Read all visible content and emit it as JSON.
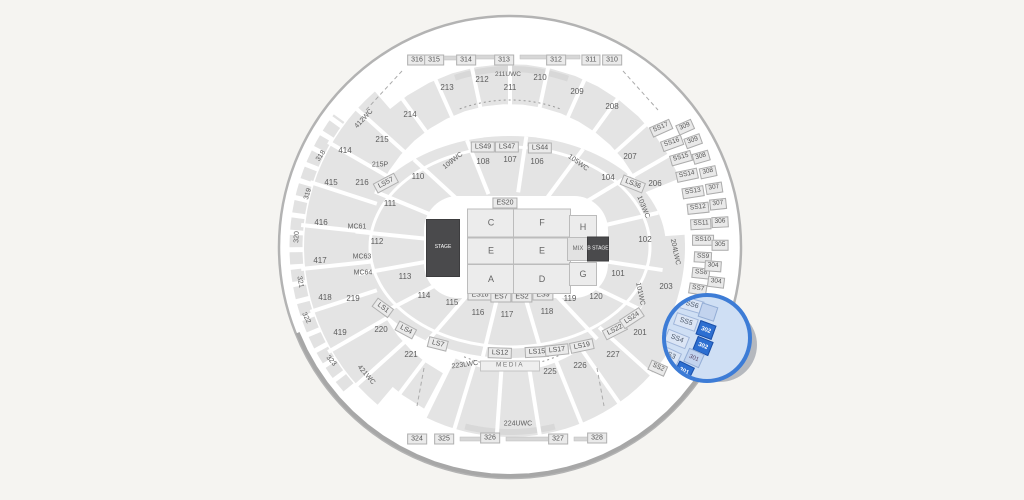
{
  "colors": {
    "background": "#f5f4f1",
    "arena_fill": "#ffffff",
    "rim": "#b3b3b3",
    "section_gray": "#e4e4e4",
    "label_text": "#5d5d5d",
    "stage_dark": "#4a4a4c",
    "magnifier_ring": "#3d7cd6",
    "magnifier_fill": "#cfdff4",
    "selected_section": "#2d6fd1"
  },
  "labels": [
    {
      "t": "316",
      "x": 417,
      "y": 60,
      "k": "tb"
    },
    {
      "t": "315",
      "x": 434,
      "y": 60,
      "k": "tb"
    },
    {
      "t": "314",
      "x": 466,
      "y": 60,
      "k": "tb"
    },
    {
      "t": "313",
      "x": 504,
      "y": 60,
      "k": "tb"
    },
    {
      "t": "312",
      "x": 556,
      "y": 60,
      "k": "tb"
    },
    {
      "t": "311",
      "x": 591,
      "y": 60,
      "k": "tb"
    },
    {
      "t": "310",
      "x": 612,
      "y": 60,
      "k": "tb"
    },
    {
      "t": "324",
      "x": 417,
      "y": 439,
      "k": "tb"
    },
    {
      "t": "325",
      "x": 444,
      "y": 439,
      "k": "tb"
    },
    {
      "t": "326",
      "x": 490,
      "y": 438,
      "k": "tb"
    },
    {
      "t": "327",
      "x": 558,
      "y": 439,
      "k": "tb"
    },
    {
      "t": "328",
      "x": 597,
      "y": 438,
      "k": "tb"
    },
    {
      "t": "214",
      "x": 410,
      "y": 115
    },
    {
      "t": "213",
      "x": 447,
      "y": 88
    },
    {
      "t": "212",
      "x": 482,
      "y": 80
    },
    {
      "t": "211",
      "x": 510,
      "y": 88
    },
    {
      "t": "210",
      "x": 540,
      "y": 78
    },
    {
      "t": "209",
      "x": 577,
      "y": 92
    },
    {
      "t": "208",
      "x": 612,
      "y": 107
    },
    {
      "t": "215",
      "x": 382,
      "y": 140
    },
    {
      "t": "216",
      "x": 362,
      "y": 183
    },
    {
      "t": "219",
      "x": 353,
      "y": 299
    },
    {
      "t": "220",
      "x": 381,
      "y": 330
    },
    {
      "t": "221",
      "x": 411,
      "y": 355
    },
    {
      "t": "225",
      "x": 550,
      "y": 372
    },
    {
      "t": "226",
      "x": 580,
      "y": 366
    },
    {
      "t": "227",
      "x": 613,
      "y": 355
    },
    {
      "t": "201",
      "x": 640,
      "y": 333
    },
    {
      "t": "203",
      "x": 666,
      "y": 287
    },
    {
      "t": "206",
      "x": 655,
      "y": 184
    },
    {
      "t": "207",
      "x": 630,
      "y": 157
    },
    {
      "t": "215P",
      "x": 380,
      "y": 165,
      "s": 7
    },
    {
      "t": "211UWC",
      "x": 508,
      "y": 75,
      "s": 6.5
    },
    {
      "t": "224UWC",
      "x": 518,
      "y": 424,
      "s": 7
    },
    {
      "t": "223LWC",
      "x": 465,
      "y": 365,
      "s": 7,
      "r": -8
    },
    {
      "t": "204LWC",
      "x": 675,
      "y": 252,
      "s": 7,
      "r": 78
    },
    {
      "t": "414",
      "x": 345,
      "y": 151
    },
    {
      "t": "415",
      "x": 331,
      "y": 183
    },
    {
      "t": "416",
      "x": 321,
      "y": 223
    },
    {
      "t": "417",
      "x": 320,
      "y": 261
    },
    {
      "t": "418",
      "x": 325,
      "y": 298
    },
    {
      "t": "419",
      "x": 340,
      "y": 333
    },
    {
      "t": "412WC",
      "x": 364,
      "y": 119,
      "s": 7,
      "r": -47
    },
    {
      "t": "421WC",
      "x": 366,
      "y": 375,
      "s": 7,
      "r": 49
    },
    {
      "t": "318",
      "x": 321,
      "y": 156,
      "s": 7,
      "r": -56
    },
    {
      "t": "319",
      "x": 308,
      "y": 194,
      "s": 7,
      "r": -73
    },
    {
      "t": "320",
      "x": 297,
      "y": 237,
      "s": 7,
      "r": -88
    },
    {
      "t": "321",
      "x": 300,
      "y": 282,
      "s": 7,
      "r": 79
    },
    {
      "t": "322",
      "x": 306,
      "y": 318,
      "s": 7,
      "r": 63
    },
    {
      "t": "323",
      "x": 331,
      "y": 361,
      "s": 7,
      "r": 48
    },
    {
      "t": "101",
      "x": 618,
      "y": 274
    },
    {
      "t": "102",
      "x": 645,
      "y": 240
    },
    {
      "t": "104",
      "x": 608,
      "y": 178
    },
    {
      "t": "106",
      "x": 537,
      "y": 162
    },
    {
      "t": "107",
      "x": 510,
      "y": 160
    },
    {
      "t": "108",
      "x": 483,
      "y": 162
    },
    {
      "t": "110",
      "x": 418,
      "y": 177
    },
    {
      "t": "111",
      "x": 390,
      "y": 204
    },
    {
      "t": "112",
      "x": 377,
      "y": 242
    },
    {
      "t": "113",
      "x": 405,
      "y": 277
    },
    {
      "t": "114",
      "x": 424,
      "y": 296
    },
    {
      "t": "115",
      "x": 452,
      "y": 303
    },
    {
      "t": "116",
      "x": 478,
      "y": 313
    },
    {
      "t": "117",
      "x": 507,
      "y": 315
    },
    {
      "t": "118",
      "x": 547,
      "y": 312
    },
    {
      "t": "119",
      "x": 570,
      "y": 299
    },
    {
      "t": "120",
      "x": 596,
      "y": 297
    },
    {
      "t": "109WC",
      "x": 453,
      "y": 161,
      "s": 7,
      "r": -38
    },
    {
      "t": "105WC",
      "x": 578,
      "y": 163,
      "s": 7,
      "r": 36
    },
    {
      "t": "103WC",
      "x": 643,
      "y": 207,
      "s": 7,
      "r": 68
    },
    {
      "t": "101WC",
      "x": 640,
      "y": 294,
      "s": 7,
      "r": 78
    },
    {
      "t": "MC61",
      "x": 357,
      "y": 227,
      "s": 7
    },
    {
      "t": "MC63",
      "x": 362,
      "y": 257,
      "s": 7
    },
    {
      "t": "MC64",
      "x": 363,
      "y": 273,
      "s": 7
    },
    {
      "t": "LS49",
      "x": 483,
      "y": 147,
      "k": "tb"
    },
    {
      "t": "LS47",
      "x": 507,
      "y": 147,
      "k": "tb"
    },
    {
      "t": "LS44",
      "x": 540,
      "y": 148,
      "k": "tb"
    },
    {
      "t": "LS36",
      "x": 633,
      "y": 184,
      "k": "tb",
      "r": 22
    },
    {
      "t": "LS57",
      "x": 386,
      "y": 183,
      "k": "tb",
      "r": -28
    },
    {
      "t": "LS1",
      "x": 383,
      "y": 308,
      "k": "tb",
      "r": 36
    },
    {
      "t": "LS4",
      "x": 406,
      "y": 330,
      "k": "tb",
      "r": 28
    },
    {
      "t": "LS7",
      "x": 438,
      "y": 344,
      "k": "tb",
      "r": 14
    },
    {
      "t": "LS12",
      "x": 500,
      "y": 353,
      "k": "tb",
      "r": 2
    },
    {
      "t": "LS15",
      "x": 537,
      "y": 352,
      "k": "tb",
      "r": -3
    },
    {
      "t": "LS17",
      "x": 557,
      "y": 350,
      "k": "tb",
      "r": -6
    },
    {
      "t": "LS19",
      "x": 582,
      "y": 346,
      "k": "tb",
      "r": -12
    },
    {
      "t": "LS22",
      "x": 615,
      "y": 330,
      "k": "tb",
      "r": -27
    },
    {
      "t": "LS24",
      "x": 632,
      "y": 318,
      "k": "tb",
      "r": -33
    },
    {
      "t": "ES20",
      "x": 505,
      "y": 203,
      "k": "tb"
    },
    {
      "t": "ES18",
      "x": 480,
      "y": 295,
      "k": "tb"
    },
    {
      "t": "ES7",
      "x": 501,
      "y": 297,
      "k": "tb"
    },
    {
      "t": "ES2",
      "x": 522,
      "y": 297,
      "k": "tb"
    },
    {
      "t": "ES9",
      "x": 543,
      "y": 295,
      "k": "tb"
    },
    {
      "t": "MEDIA",
      "x": 510,
      "y": 366,
      "k": "strip",
      "i": false
    },
    {
      "t": "SS17",
      "x": 661,
      "y": 128,
      "k": "sb",
      "r": -24
    },
    {
      "t": "SS16",
      "x": 672,
      "y": 143,
      "k": "sb",
      "r": -20
    },
    {
      "t": "SS15",
      "x": 681,
      "y": 158,
      "k": "sb",
      "r": -16
    },
    {
      "t": "SS14",
      "x": 687,
      "y": 175,
      "k": "sb",
      "r": -12
    },
    {
      "t": "SS13",
      "x": 693,
      "y": 192,
      "k": "sb",
      "r": -9
    },
    {
      "t": "SS12",
      "x": 698,
      "y": 208,
      "k": "sb",
      "r": -6
    },
    {
      "t": "SS11",
      "x": 701,
      "y": 224,
      "k": "sb",
      "r": -3
    },
    {
      "t": "SS10",
      "x": 703,
      "y": 240,
      "k": "sb",
      "r": 0
    },
    {
      "t": "SS9",
      "x": 703,
      "y": 257,
      "k": "sb",
      "r": 3
    },
    {
      "t": "SS8",
      "x": 701,
      "y": 273,
      "k": "sb",
      "r": 6
    },
    {
      "t": "SS7",
      "x": 698,
      "y": 289,
      "k": "sb",
      "r": 9
    },
    {
      "t": "SS2",
      "x": 658,
      "y": 368,
      "k": "sb",
      "r": 24
    },
    {
      "t": "309",
      "x": 685,
      "y": 127,
      "k": "sb",
      "r": -24
    },
    {
      "t": "309",
      "x": 693,
      "y": 141,
      "k": "sb",
      "r": -20
    },
    {
      "t": "308",
      "x": 701,
      "y": 157,
      "k": "sb",
      "r": -16
    },
    {
      "t": "308",
      "x": 708,
      "y": 172,
      "k": "sb",
      "r": -12
    },
    {
      "t": "307",
      "x": 714,
      "y": 188,
      "k": "sb",
      "r": -9
    },
    {
      "t": "307",
      "x": 718,
      "y": 204,
      "k": "sb",
      "r": -6
    },
    {
      "t": "306",
      "x": 720,
      "y": 222,
      "k": "sb",
      "r": -3
    },
    {
      "t": "305",
      "x": 720,
      "y": 245,
      "k": "sb",
      "r": 0
    },
    {
      "t": "304",
      "x": 713,
      "y": 266,
      "k": "sb",
      "r": 4
    },
    {
      "t": "304",
      "x": 716,
      "y": 282,
      "k": "sb",
      "r": 7
    }
  ],
  "floor": [
    {
      "t": "C",
      "x": 491,
      "y": 223,
      "w": 46,
      "h": 27,
      "k": "fb"
    },
    {
      "t": "F",
      "x": 542,
      "y": 223,
      "w": 56,
      "h": 27,
      "k": "fb"
    },
    {
      "t": "E",
      "x": 491,
      "y": 251,
      "w": 46,
      "h": 25,
      "k": "fb"
    },
    {
      "t": "E",
      "x": 542,
      "y": 251,
      "w": 56,
      "h": 25,
      "k": "fb"
    },
    {
      "t": "A",
      "x": 491,
      "y": 279,
      "w": 46,
      "h": 28,
      "k": "fb"
    },
    {
      "t": "D",
      "x": 542,
      "y": 279,
      "w": 56,
      "h": 28,
      "k": "fb"
    },
    {
      "t": "H",
      "x": 583,
      "y": 227,
      "w": 26,
      "h": 22,
      "k": "fb"
    },
    {
      "t": "G",
      "x": 583,
      "y": 274,
      "w": 26,
      "h": 22,
      "k": "fb"
    },
    {
      "t": "MIX",
      "x": 578,
      "y": 249,
      "w": 20,
      "h": 22,
      "k": "fbs",
      "i": false
    },
    {
      "t": "STAGE",
      "x": 443,
      "y": 248,
      "w": 32,
      "h": 56,
      "k": "dk",
      "i": false
    },
    {
      "t": "B STAGE",
      "x": 598,
      "y": 249,
      "w": 20,
      "h": 23,
      "k": "dk",
      "i": false
    }
  ],
  "magnifier": {
    "cx": 707,
    "cy": 338,
    "r": 45,
    "sections": [
      {
        "t": "SS6",
        "x": 692,
        "y": 305,
        "r": 16,
        "k": "ss"
      },
      {
        "t": "SS5",
        "x": 686,
        "y": 322,
        "r": 19,
        "k": "ss"
      },
      {
        "t": "SS4",
        "x": 677,
        "y": 339,
        "r": 22,
        "k": "ss"
      },
      {
        "t": "SS3",
        "x": 669,
        "y": 355,
        "r": 25,
        "k": "ss"
      },
      {
        "t": "",
        "x": 708,
        "y": 312,
        "r": 18,
        "k": "tier",
        "sel": false
      },
      {
        "t": "302",
        "x": 706,
        "y": 330,
        "r": 20,
        "k": "tier",
        "sel": true
      },
      {
        "t": "302",
        "x": 703,
        "y": 346,
        "r": 22,
        "k": "tier",
        "sel": true
      },
      {
        "t": "301",
        "x": 694,
        "y": 358,
        "r": 24,
        "k": "tier",
        "sel": false
      },
      {
        "t": "301",
        "x": 684,
        "y": 371,
        "r": 26,
        "k": "tier",
        "sel": true
      }
    ]
  }
}
